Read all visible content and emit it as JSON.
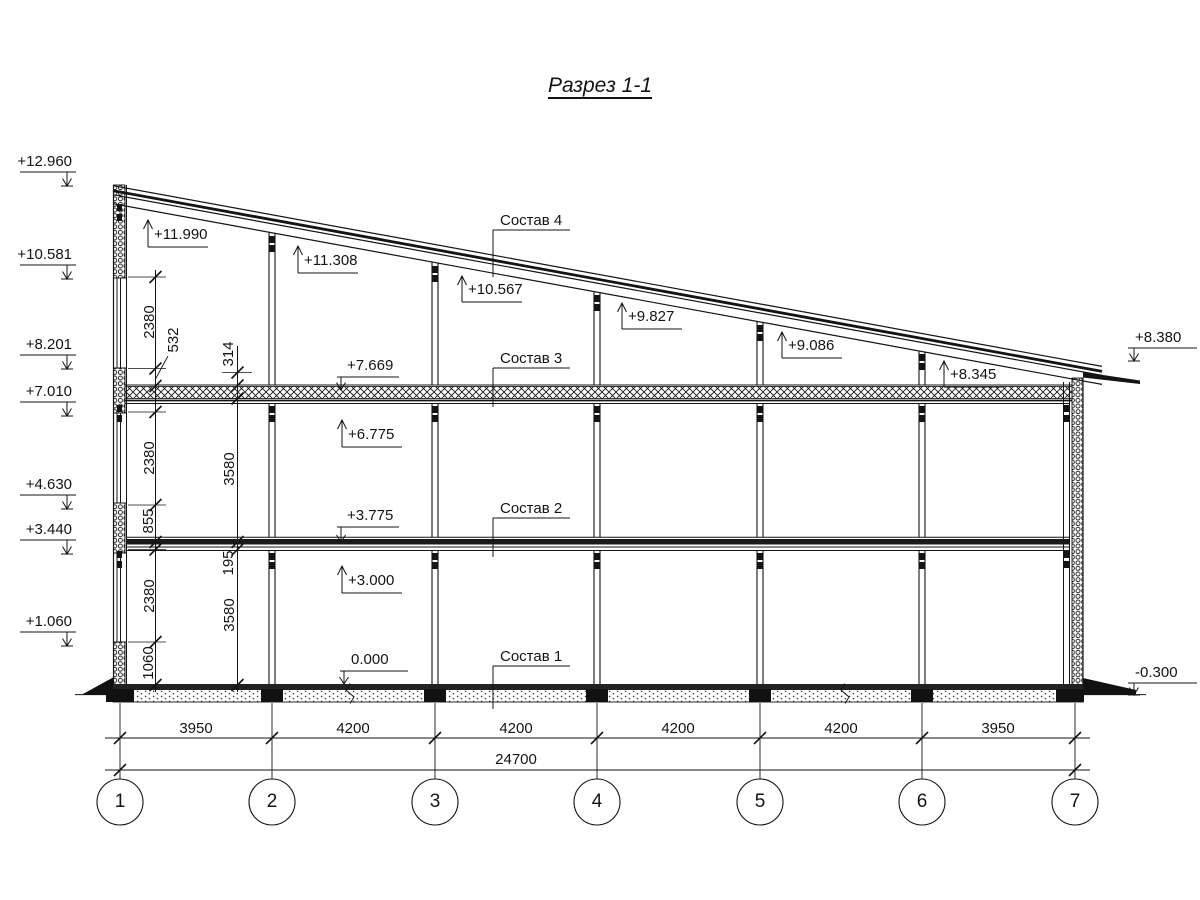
{
  "title": "Разрез 1-1",
  "marks_left": [
    "+12.960",
    "+10.581",
    "+8.201",
    "+7.010",
    "+4.630",
    "+3.440",
    "+1.060"
  ],
  "marks_roof": [
    "+11.990",
    "+11.308",
    "+10.567",
    "+9.827",
    "+9.086",
    "+8.345"
  ],
  "marks_floor_top": [
    "+7.669",
    "+3.775",
    "0.000"
  ],
  "marks_floor_bottom": [
    "+6.775",
    "+3.000"
  ],
  "marks_right": [
    "+8.380",
    "-0.300"
  ],
  "layers": [
    "Состав 4",
    "Состав 3",
    "Состав 2",
    "Состав 1"
  ],
  "dims_vertical_inner": [
    "2380",
    "532",
    "2380",
    "855",
    "2380",
    "1060"
  ],
  "dims_vertical_outer": [
    "314",
    "3580",
    "195",
    "3580"
  ],
  "dims_spans": [
    "3950",
    "4200",
    "4200",
    "4200",
    "4200",
    "3950"
  ],
  "dims_total": "24700",
  "axes": [
    "1",
    "2",
    "3",
    "4",
    "5",
    "6",
    "7"
  ],
  "line_color": "#141414"
}
